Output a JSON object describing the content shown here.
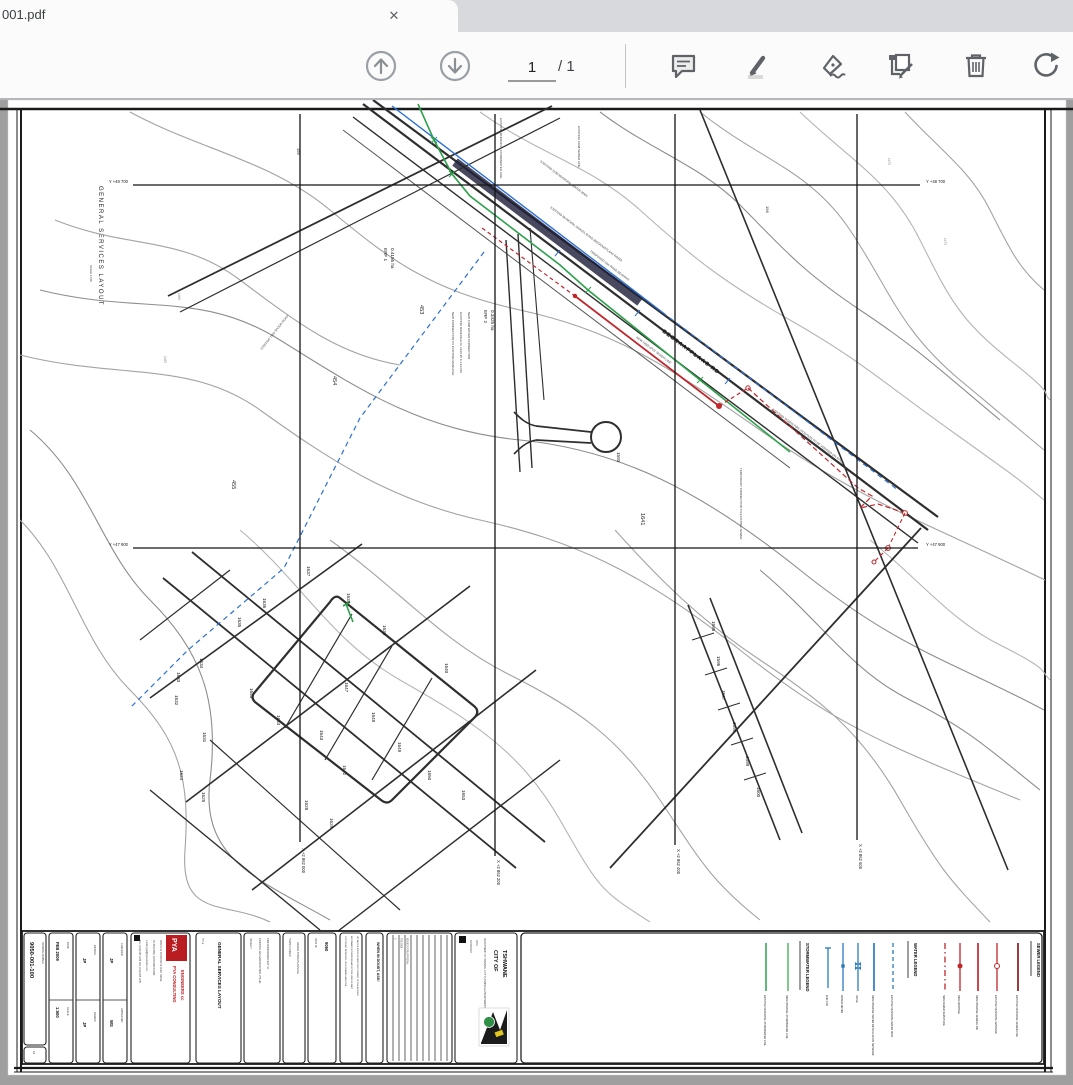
{
  "browser": {
    "tab_title": "001.pdf",
    "close_glyph": "✕"
  },
  "toolbar": {
    "page_value": "1",
    "page_total": "/ 1"
  },
  "colors": {
    "sewer": "#c0272d",
    "water": "#2b6fd4",
    "storm": "#2ca14a",
    "toolbar_icon": "#5f6368"
  },
  "margin": {
    "title": "GENERAL SERVICES LAYOUT",
    "scale": "SCALE 1:500"
  },
  "grid": {
    "top_left": "Y +48 700",
    "top_right": "Y +48 700",
    "mid_left": "Y +47 900",
    "mid_right": "Y +47 900",
    "x1": "X +2 862 000",
    "x2": "X +2 862 200",
    "x3": "X +2 862 400",
    "x4": "X +2 862 600"
  },
  "drawing": {
    "road_label": "BEGRAAFPLAAS RD",
    "erf1": "ERF 1",
    "erf1_area": "0.4156 ha",
    "erf2": "ERF 2",
    "erf2_area": "0.3425 ha",
    "erven": [
      "453",
      "454",
      "455",
      "1593",
      "1641",
      "1595",
      "1596",
      "1597",
      "1598",
      "1599",
      "1600",
      "1637",
      "1636",
      "1635",
      "1634",
      "1633",
      "1632",
      "1631",
      "1624",
      "1625",
      "1638",
      "1639",
      "1640",
      "1645",
      "1644",
      "1643",
      "1642",
      "1647",
      "1648",
      "1649",
      "1650",
      "1653",
      "1628",
      "1629"
    ],
    "contours": [
      "199",
      "196",
      "1460",
      "1465",
      "1470",
      "1475"
    ],
    "annotations": [
      "EXISTING MUNICIPAL STORMWATER LINE",
      "EXISTING 110Ø MUNICIPAL WATER MAIN",
      "EXISTING MUNICIPAL GRAVEL ROAD (BEGRAAFPLAAS ROAD)",
      "PROPOSED 16m ROAD RESERVE",
      "NEW 160Ø uPVC SEWER LINE",
      "EXISTING SEWER PIPE (POSITION TO BE VERIFIED ON SITE)",
      "NEW CONNECTION TO EXISTING MANHOLE",
      "EXISTING MANHOLE CL 1436.25  IL 1434.80",
      "NEW 110Ø WATER CONNECTION",
      "EXISTING TWO SPOOR ROAD",
      "TEMPORARY CONNECTION TO EXISTING SEWER",
      "EXISTING 160Ø SEWER LINE"
    ]
  },
  "titleblock": {
    "drawing_number": "9050-001-100",
    "drawing_number_label": "DRAWING NUMBER",
    "sheet": "A3",
    "date_value": "FEB 2009",
    "date_label": "DATE",
    "scale_value": "1:500",
    "scale_label": "SCALE",
    "design_value": "JP",
    "design_label": "DESIGN",
    "drawn_value": "JP",
    "drawn_label": "DRAWN",
    "checked_value": "JP",
    "checked_label": "CHECKED",
    "approved_value": "WS",
    "approved_label": "APPROVED",
    "firm_logo": "PYA",
    "firm_name1": "PYA CONSULTING",
    "firm_name2": "ENGINEERS cc",
    "firm_addr1": "ROUTE 21 CORPORATE PARK, IRENE",
    "firm_addr2": "PO BOX 8052, CENTURION 0046",
    "firm_addr3": "TEL: (012) 665 1234  FAX: (012) 665 1235",
    "firm_addr4": "e-mail: pya@pyaconsult.co.za",
    "title_label": "TITLE",
    "title_value": "GENERAL SERVICES LAYOUT",
    "project_label": "PROJECT",
    "project_line1": "PORTION 123 GARSFONTEIN 375-JR",
    "project_line2": "PRETORIUSPARK EXT 37",
    "planner_label": "TOWN PLANNER",
    "planner_value": "ORIGIN TOWN PLANNING",
    "ref_label": "PROJ No",
    "ref_value": "9050",
    "disclaimer1": "COPYRIGHT RESERVED. THIS DRAWING AND THE",
    "disclaimer2": "INFORMATION THEREON MAY NOT BE USED IN PART",
    "disclaimer3": "OR WHOLE WITHOUT WRITTEN CONSENT OF THE AUTHOR",
    "doubt": "WHEN IN DOUBT, ASK!",
    "rev_no": "0",
    "rev_date": "FEB 2009",
    "rev_desc": "ISSUED FOR APPROVAL",
    "city_name1": "CITY OF",
    "city_name2": "TSHWANE",
    "city_dept": "DEPARTMENT OF HOUSING, CITY PLANNING & ENVIRONMENTAL MANAGEMENT",
    "city_approved": "APPROVED:",
    "city_date": "DATE:"
  },
  "legends": {
    "storm_title": "STORMWATER LEGEND",
    "storm_items": [
      "EXISTING MUNICIPAL STORMWATER LINE",
      "NEW INTERNAL STORMWATER LINE"
    ],
    "water_title": "WATER LEGEND",
    "water_items": [
      "END CAP",
      "WATER METER",
      "VALVE",
      "NEW INTERNAL WATER RETICULATION NETWORK",
      "EXISTING MUNICIPAL WATER MAIN"
    ],
    "sewer_title": "SEWER LEGEND",
    "sewer_items": [
      "NEW SEWER SERVITUDE",
      "NEW MANHOLE",
      "NEW INTERNAL SEWER LINE",
      "EXISTING MUNICIPAL MANHOLE",
      "EXISTING MUNICIPAL SEWER LINE"
    ]
  }
}
